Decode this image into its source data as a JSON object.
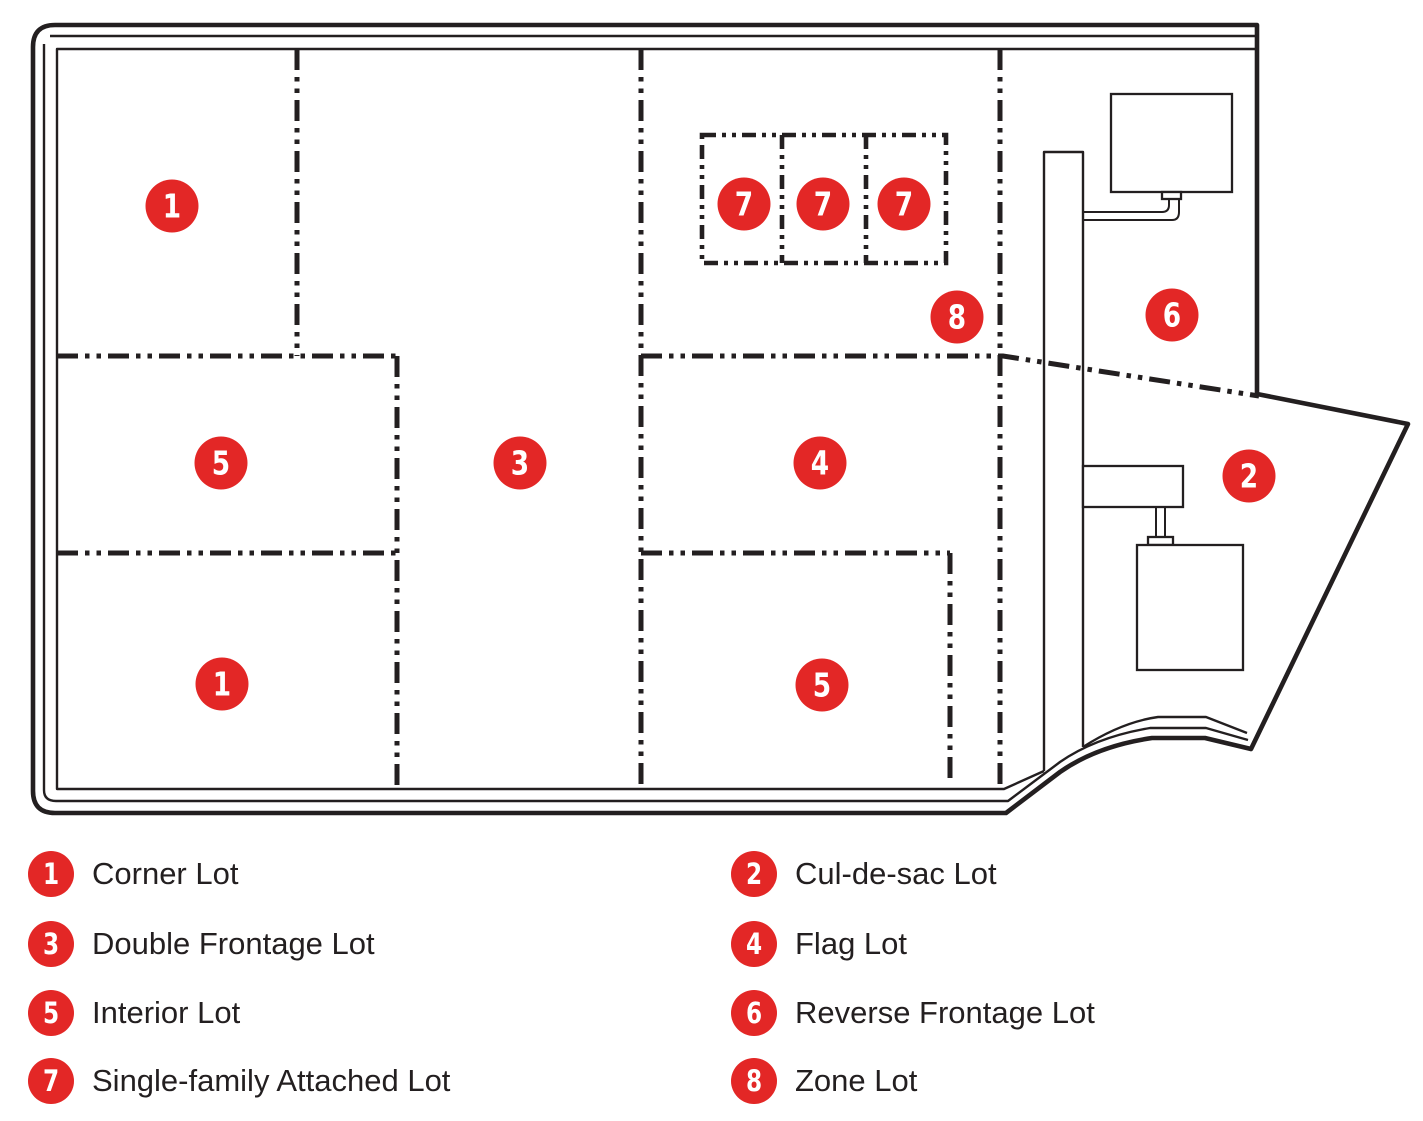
{
  "colors": {
    "marker_red": "#e32726",
    "line_black": "#231f20",
    "background": "#ffffff"
  },
  "map": {
    "markers": [
      "1",
      "7",
      "7",
      "7",
      "8",
      "6",
      "5",
      "3",
      "4",
      "2",
      "1",
      "5"
    ]
  },
  "legend": {
    "left": [
      {
        "num": "1",
        "label": "Corner Lot"
      },
      {
        "num": "3",
        "label": "Double Frontage Lot"
      },
      {
        "num": "5",
        "label": "Interior Lot"
      },
      {
        "num": "7",
        "label": "Single-family Attached Lot"
      }
    ],
    "right": [
      {
        "num": "2",
        "label": "Cul-de-sac Lot"
      },
      {
        "num": "4",
        "label": "Flag Lot"
      },
      {
        "num": "6",
        "label": "Reverse Frontage Lot"
      },
      {
        "num": "8",
        "label": "Zone Lot"
      }
    ]
  }
}
